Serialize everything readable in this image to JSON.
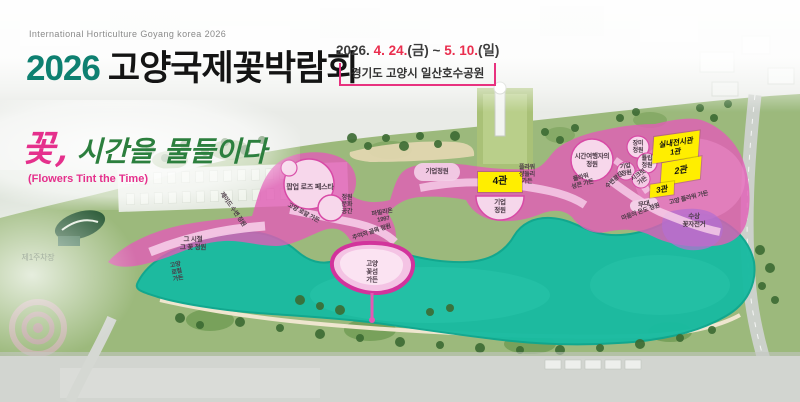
{
  "header": {
    "subtitle": "International Horticulture Goyang korea 2026",
    "title_year": "2026",
    "title_kr": "고양국제꽃박람회",
    "date": {
      "prefix": "2026.",
      "start": "4. 24.",
      "start_day": "(금)",
      "tilde": "~",
      "end": "5. 10.",
      "end_day": "(일)"
    },
    "venue": "경기도 고양시 일산호수공원"
  },
  "slogan": {
    "flower": "꽃,",
    "text": "시간을 물들이다",
    "english": "(Flowers Tint the Time)"
  },
  "map": {
    "halls": [
      {
        "label": "실내전시관\n1관"
      },
      {
        "label": "2관"
      },
      {
        "label": "3관"
      },
      {
        "label": "4관"
      }
    ],
    "labels": [
      {
        "text": "팝업 로즈 페스타"
      },
      {
        "text": "기업정원"
      },
      {
        "text": "기업\n정원"
      },
      {
        "text": "정원\n문화\n공간"
      },
      {
        "text": "파빌리온\n1997"
      },
      {
        "text": "추억의 골목 정원"
      },
      {
        "text": "제이드 수변 정원"
      },
      {
        "text": "고양 로얄 가든"
      },
      {
        "text": "그 시절\n그 꽃 정원"
      },
      {
        "text": "고양\n로컬\n가든"
      },
      {
        "text": "고양\n꽃섬\n가든"
      },
      {
        "text": "플라워\n샹들리\n가든"
      },
      {
        "text": "시간여행자의\n정원"
      },
      {
        "text": "플라워\n성큰 가든"
      },
      {
        "text": "장미\n정원"
      },
      {
        "text": "튤립\n정원"
      },
      {
        "text": "기업\n정원"
      },
      {
        "text": "시크릿\n가든"
      },
      {
        "text": "수변광장"
      },
      {
        "text": "무대"
      },
      {
        "text": "고양 플라워 가든"
      },
      {
        "text": "마음의 온도 정원"
      },
      {
        "text": "수상\n꽃자전거"
      },
      {
        "text": "제1주차장"
      }
    ],
    "colors": {
      "accent_pink": "#e8327f",
      "title_teal": "#0e8071",
      "date_red": "#ea2e4e",
      "hall_yellow": "#ffee00",
      "lake_teal": "#19bba1",
      "zone_pink": "#e25cb6"
    }
  }
}
